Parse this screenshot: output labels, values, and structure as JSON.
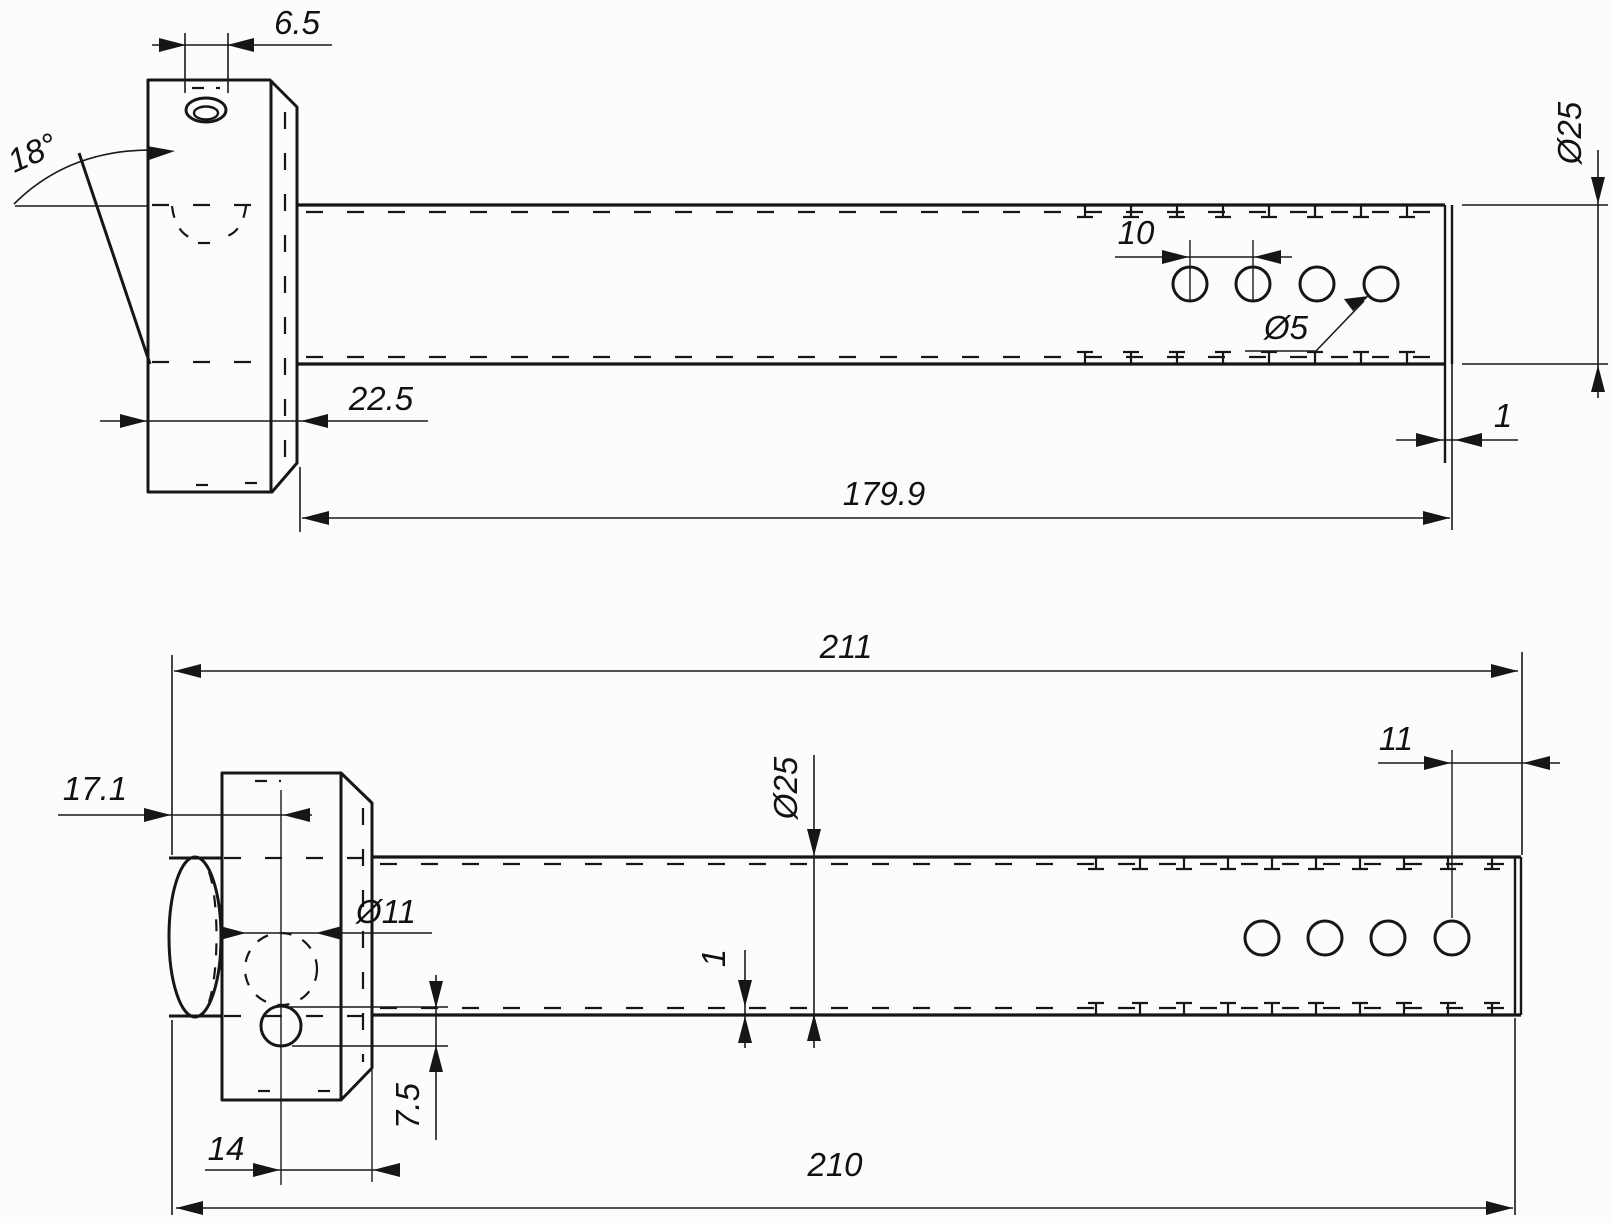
{
  "drawing": {
    "paper_color": "#fcfcfa",
    "line_color": "#161616",
    "side_view": {
      "slot_width": "6.5",
      "cut_angle": "18°",
      "hole_pitch": "10",
      "hole_diameter": "Ø5",
      "block_depth": "22.5",
      "tube_length": "179.9",
      "tube_diameter": "Ø25",
      "end_plate_thickness": "1"
    },
    "plan_view": {
      "overall_length": "211",
      "bar_end_to_hole": "17.1",
      "bore_diameter": "Ø11",
      "tube_diameter": "Ø25",
      "wall_thickness": "1",
      "last_hole_to_end": "11",
      "hole_height": "7.5",
      "hole_to_face": "14",
      "body_length": "210"
    }
  }
}
